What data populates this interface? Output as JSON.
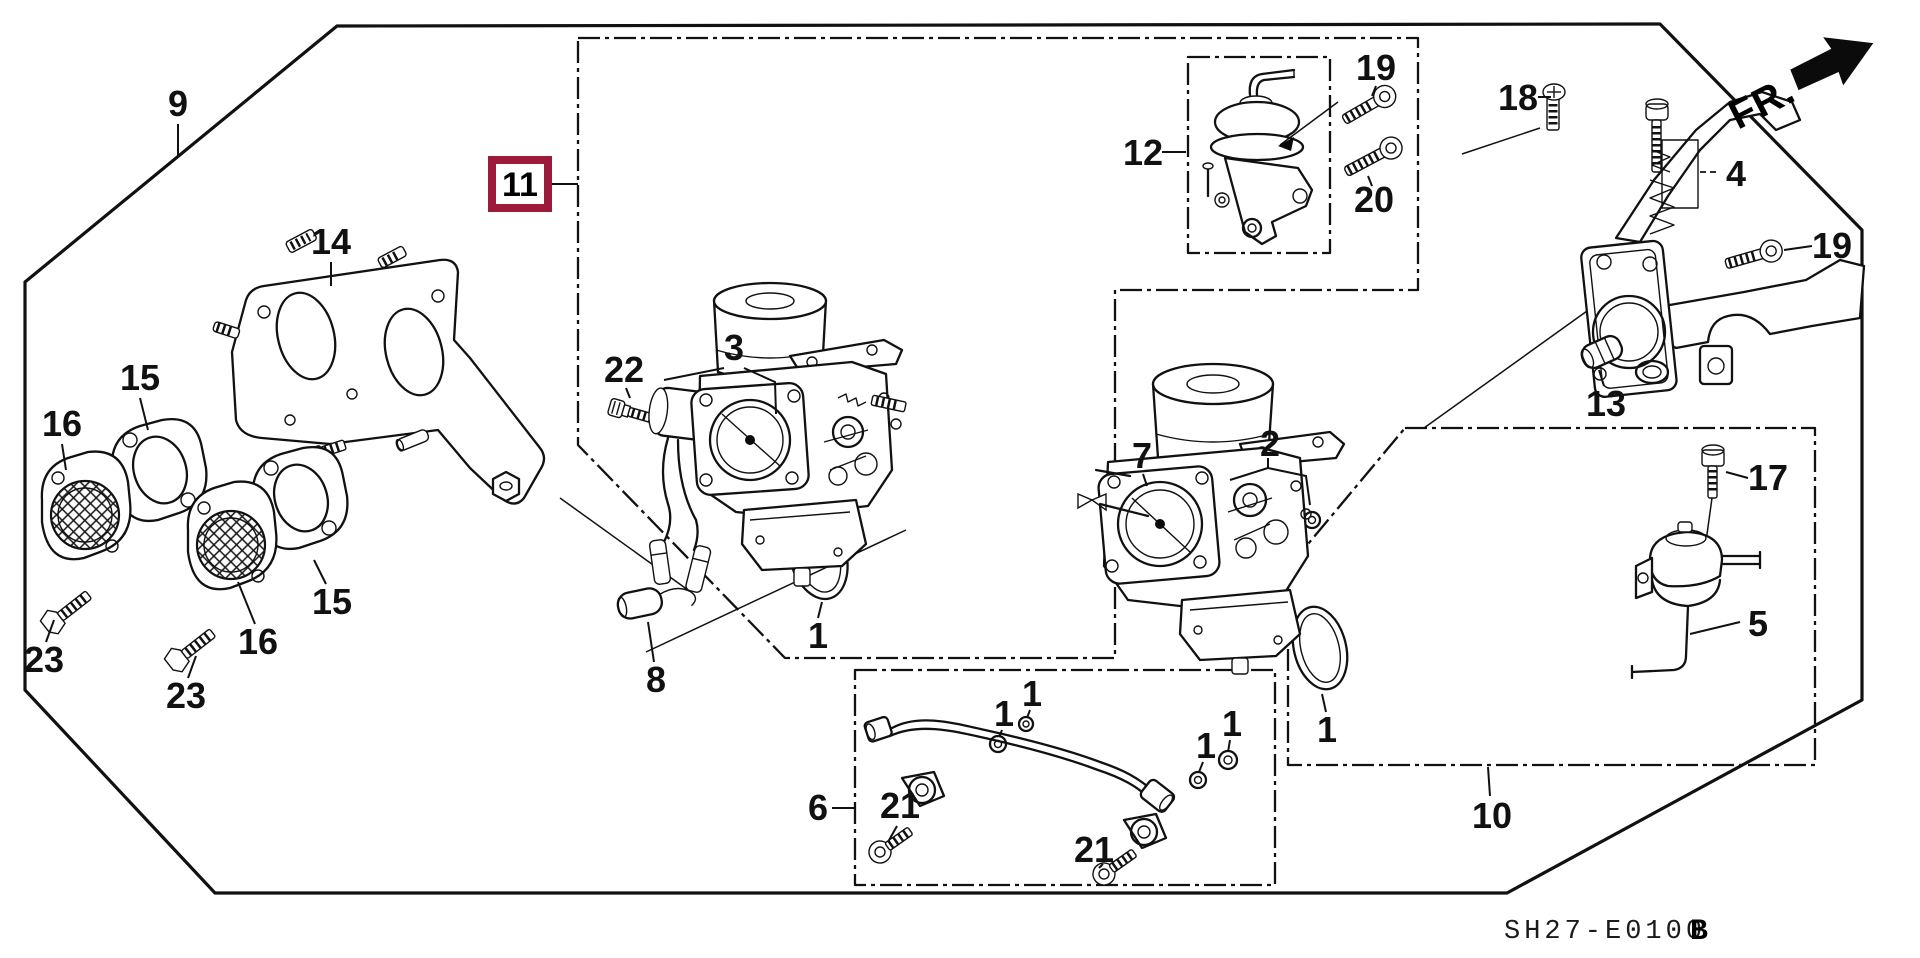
{
  "colors": {
    "highlight": "#9D1B3A",
    "ink": "#111111",
    "paper": "#FFFFFF"
  },
  "direction": {
    "label": "FR."
  },
  "footer": {
    "diagram_code": "SH27-E0100",
    "revision": "B"
  },
  "highlight_box": {
    "part": "11"
  },
  "callouts": {
    "p9": "9",
    "p14": "14",
    "p15_top": "15",
    "p15_bottom": "15",
    "p16_top": "16",
    "p16_bottom": "16",
    "p23_left": "23",
    "p23_right": "23",
    "p11": "11",
    "p22": "22",
    "p3": "3",
    "p8": "8",
    "p1_main": "1",
    "p12": "12",
    "p19_box": "19",
    "p20": "20",
    "p18": "18",
    "p4": "4",
    "p19_bracket": "19",
    "p13": "13",
    "p7": "7",
    "p2": "2",
    "p17": "17",
    "p5": "5",
    "p1_carb2": "1",
    "p10": "10",
    "p6": "6",
    "p21_left": "21",
    "p21_right": "21",
    "p1_pipe_a": "1",
    "p1_pipe_b": "1",
    "p1_pipe_c": "1",
    "p1_pipe_d": "1"
  }
}
